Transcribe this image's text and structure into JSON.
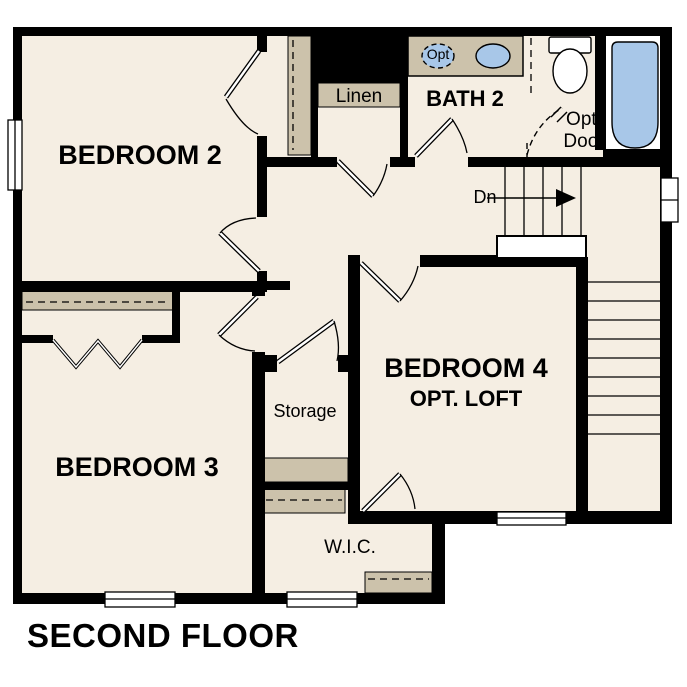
{
  "title": "SECOND FLOOR",
  "rooms": {
    "bedroom2": "BEDROOM 2",
    "bedroom3": "BEDROOM 3",
    "bedroom4": "BEDROOM 4",
    "bedroom4_sub": "OPT. LOFT",
    "bath2": "BATH 2",
    "linen": "Linen",
    "storage": "Storage",
    "wic": "W.I.C."
  },
  "annotations": {
    "stairs_down": "Dn",
    "optional_door_line1": "Opt.",
    "optional_door_line2": "Door",
    "optional_sink": "Opt"
  },
  "colors": {
    "floor": "#f5eee3",
    "millwork": "#ccc2ab",
    "fixture_blue": "#a8c7e8",
    "wall": "#000000",
    "background": "#ffffff"
  }
}
